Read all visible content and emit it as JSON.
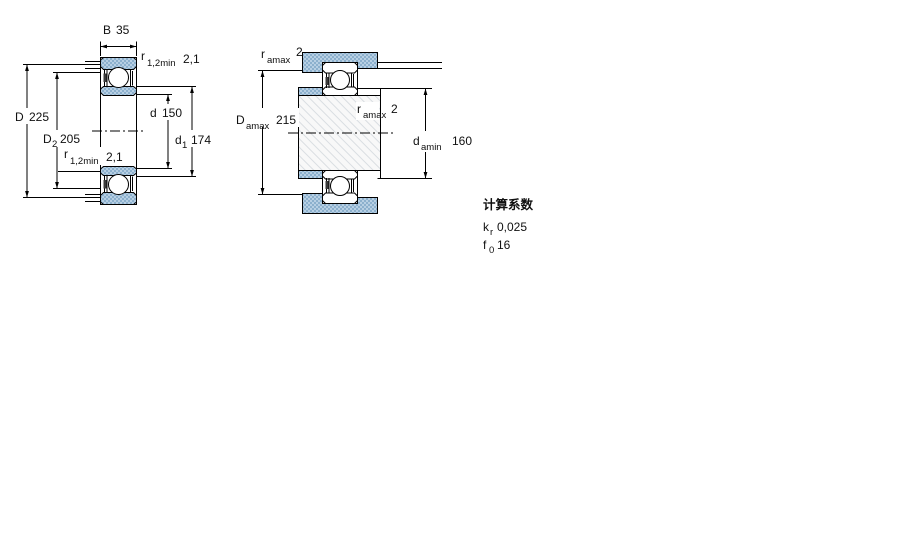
{
  "colors": {
    "line": "#000000",
    "ring_fill": "#aec8de",
    "ring_fill_dot": "#8cb0cd",
    "shaft_hatch": "#d9dde1",
    "background": "#ffffff"
  },
  "left_view": {
    "B": {
      "sym": "B",
      "val": "35"
    },
    "r_top": {
      "sym": "r",
      "sub": "1,2min",
      "val": "2,1"
    },
    "D": {
      "sym": "D",
      "val": "225"
    },
    "D2": {
      "sym": "D",
      "sub": "2",
      "val": "205"
    },
    "r_bottom": {
      "sym": "r",
      "sub": "1,2min",
      "val": "2,1"
    },
    "d": {
      "sym": "d",
      "val": "150"
    },
    "d1": {
      "sym": "d",
      "sub": "1",
      "val": "174"
    }
  },
  "right_view": {
    "r_a_top": {
      "sym": "r",
      "sub": "amax",
      "val": "2"
    },
    "D_a": {
      "sym": "D",
      "sub": "amax",
      "val": "215"
    },
    "r_a_mid": {
      "sym": "r",
      "sub": "amax",
      "val": "2"
    },
    "d_a": {
      "sym": "d",
      "sub": "amin",
      "val": "160"
    }
  },
  "factors": {
    "heading": "计算系数",
    "rows": [
      {
        "sym": "k",
        "sub": "r",
        "val": "0,025"
      },
      {
        "sym": "f",
        "sub": "0",
        "val": "16"
      }
    ]
  }
}
